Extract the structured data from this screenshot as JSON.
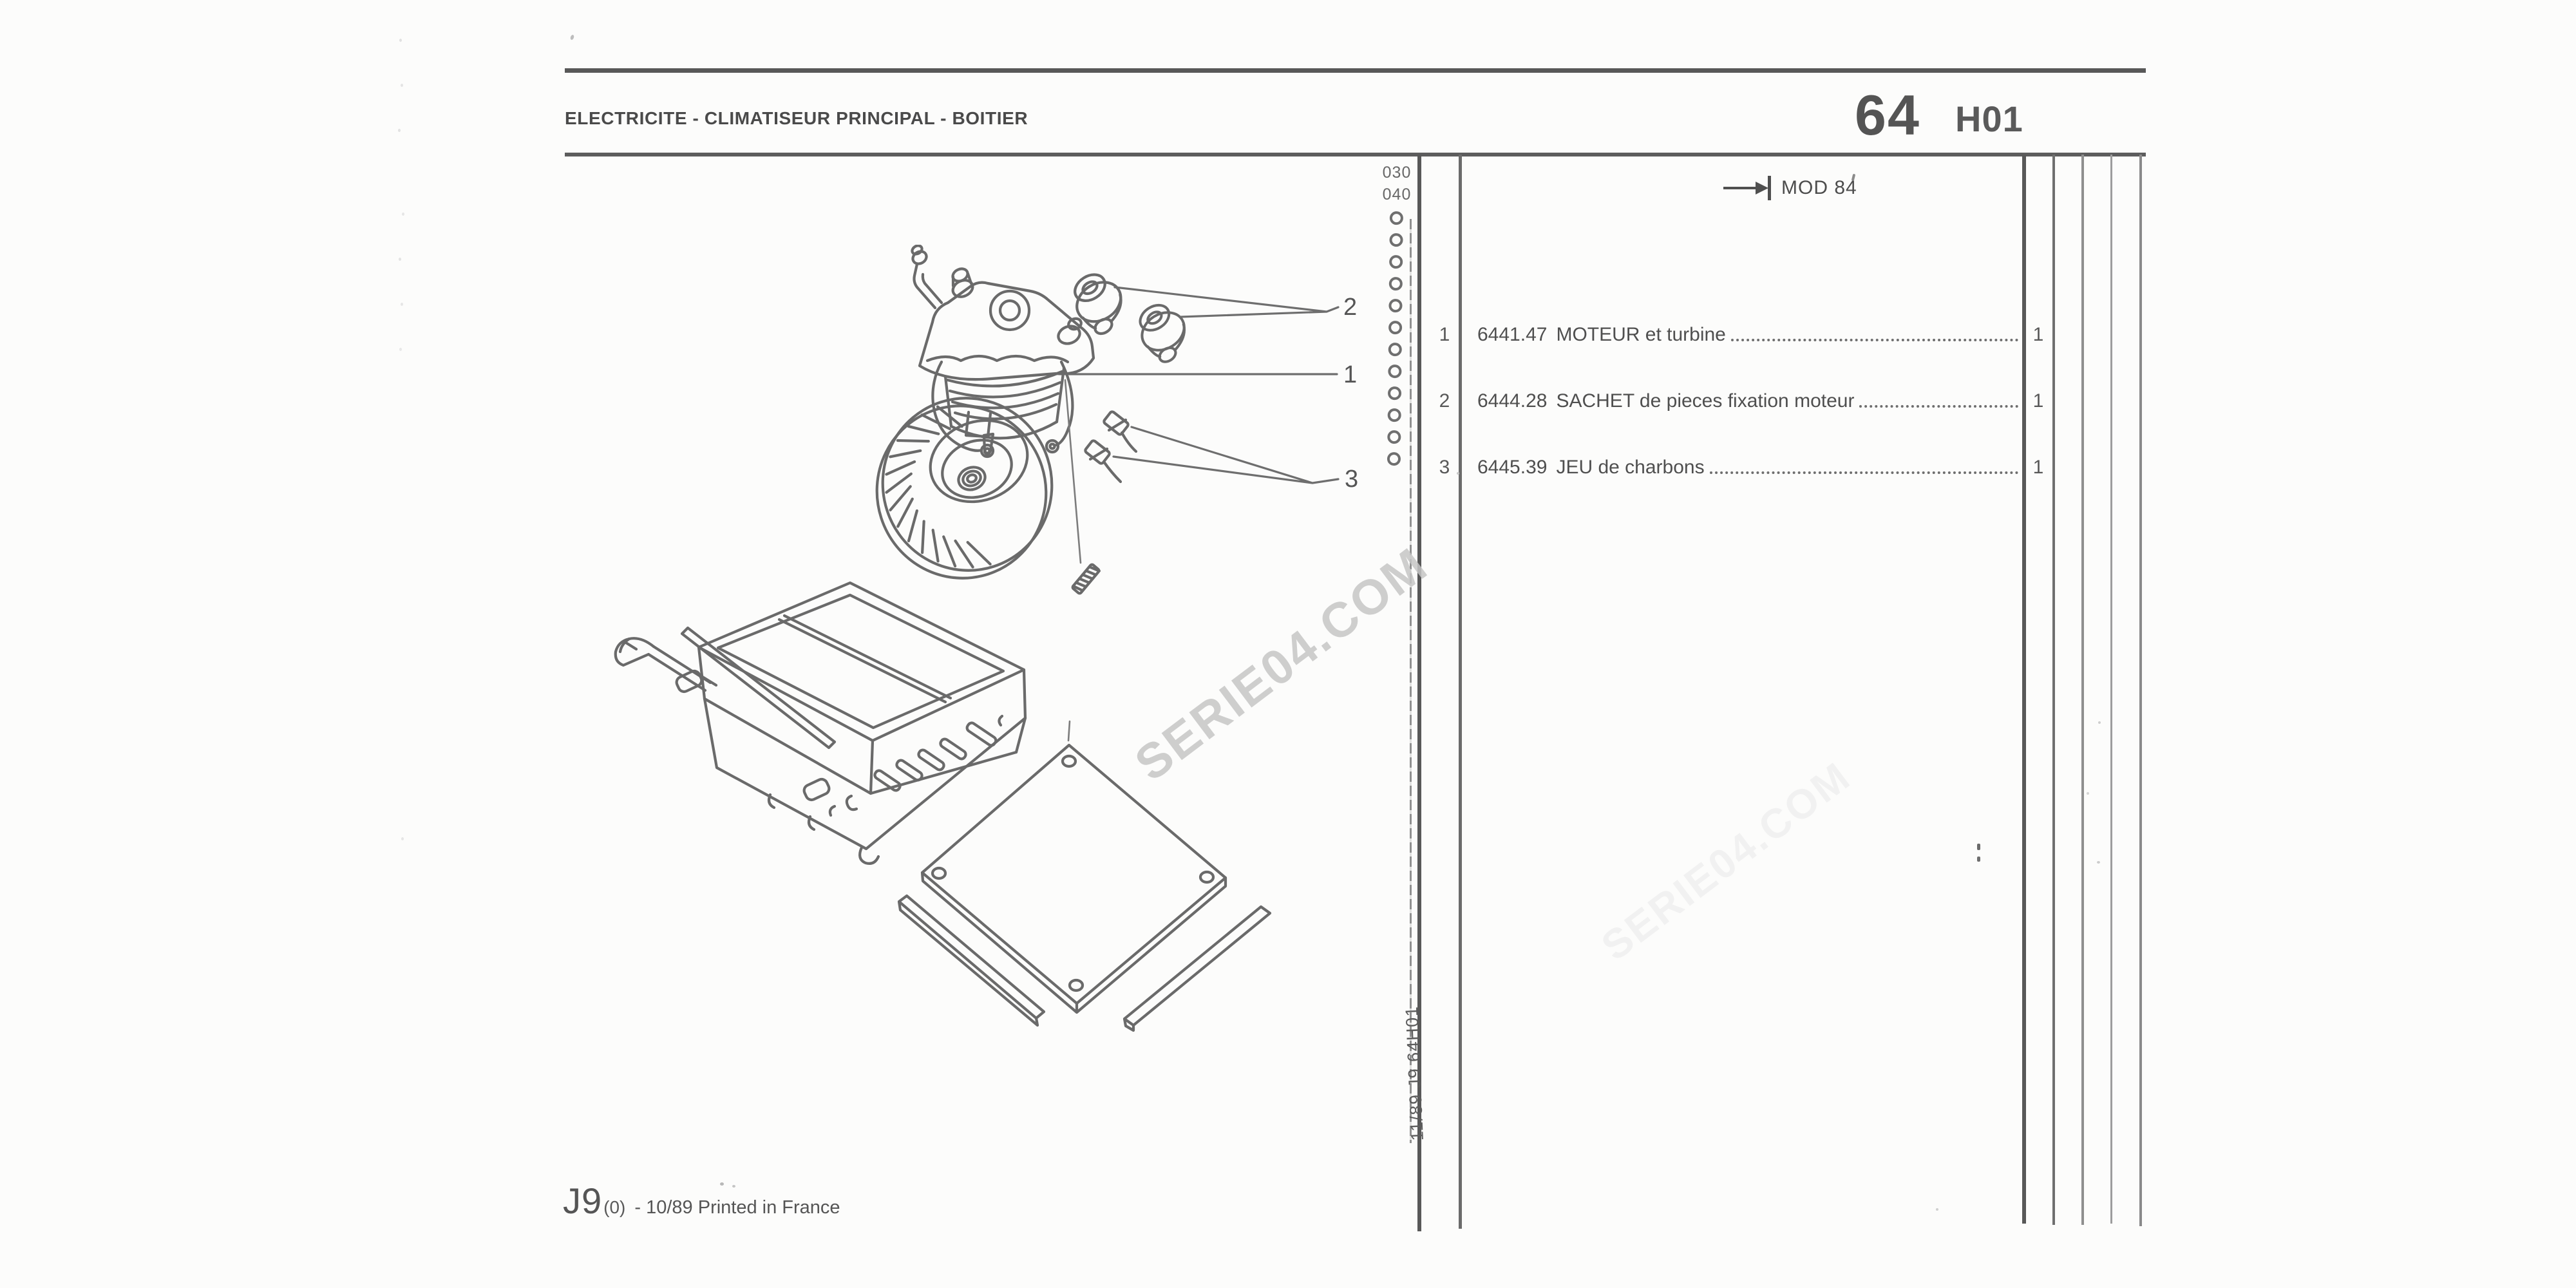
{
  "header": {
    "title": "ELECTRICITE - CLIMATISEUR PRINCIPAL - BOITIER",
    "chapter": "64",
    "sheet": "H01"
  },
  "margin_refs": {
    "top": "030",
    "bottom": "040"
  },
  "mod_note": {
    "label": "MOD 84"
  },
  "parts_list": {
    "rows": [
      {
        "item": "1",
        "ref": "6441.47",
        "name": "MOTEUR et turbine",
        "qty": "1"
      },
      {
        "item": "2",
        "ref": "6444.28",
        "name": "SACHET de pieces fixation moteur",
        "qty": "1"
      },
      {
        "item": "3",
        "ref": "6445.39",
        "name": "JEU de charbons",
        "qty": "1"
      }
    ]
  },
  "diagram": {
    "callout_1": "1",
    "callout_2": "2",
    "callout_3": "3"
  },
  "sidebar_text": "11/89  J9  64H01",
  "footer": {
    "model": "J9",
    "variant": "(0)",
    "imprint": "- 10/89 Printed in France"
  },
  "watermark": {
    "text": "SERIE04.COM"
  },
  "colors": {
    "ink": "#4f4f4f",
    "line": "#6a6a6a",
    "rule": "#585858",
    "watermark": "#c6c6c6"
  }
}
